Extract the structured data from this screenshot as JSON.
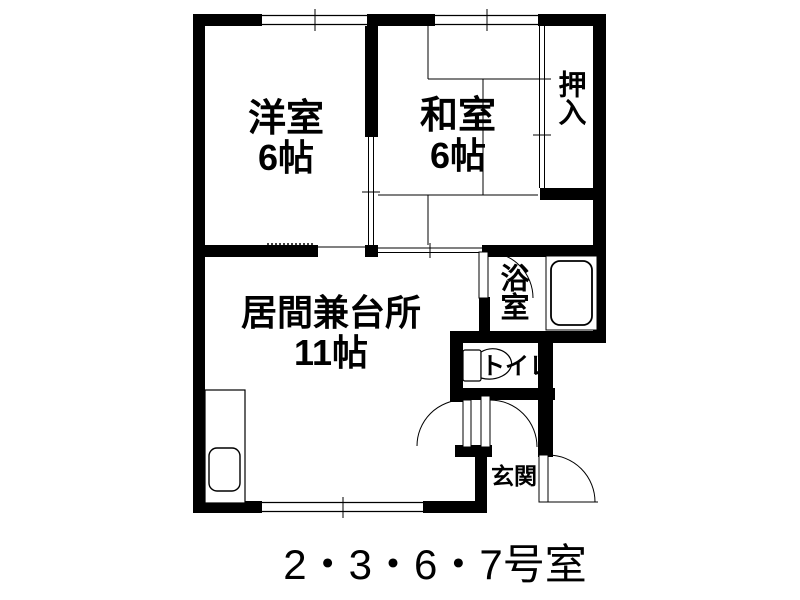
{
  "floorplan": {
    "caption": "2・3・6・7号室",
    "colors": {
      "wall": "#000000",
      "background": "#ffffff",
      "text": "#000000"
    },
    "rooms": [
      {
        "id": "western-room",
        "label": "洋室",
        "size": "6帖"
      },
      {
        "id": "japanese-room",
        "label": "和室",
        "size": "6帖"
      },
      {
        "id": "closet",
        "label": "押入",
        "size": ""
      },
      {
        "id": "living-kitchen",
        "label": "居間兼台所",
        "size": "11帖"
      },
      {
        "id": "bathroom",
        "label": "浴室",
        "size": ""
      },
      {
        "id": "toilet",
        "label": "トイレ",
        "size": ""
      },
      {
        "id": "entrance",
        "label": "玄関",
        "size": ""
      }
    ],
    "fixtures": [
      {
        "id": "bathtub",
        "name": "bathtub"
      },
      {
        "id": "toilet-bowl",
        "name": "toilet bowl with tank"
      },
      {
        "id": "kitchen-sink",
        "name": "kitchen counter with sink"
      }
    ],
    "openings": [
      "window-top-western",
      "window-top-japanese",
      "window-bottom-living",
      "sliding-door-western-japanese",
      "sliding-door-japanese-living",
      "sliding-door-closet",
      "swing-door-bathroom",
      "swing-door-hall-living",
      "swing-door-hall-toilet",
      "entry-door"
    ]
  }
}
